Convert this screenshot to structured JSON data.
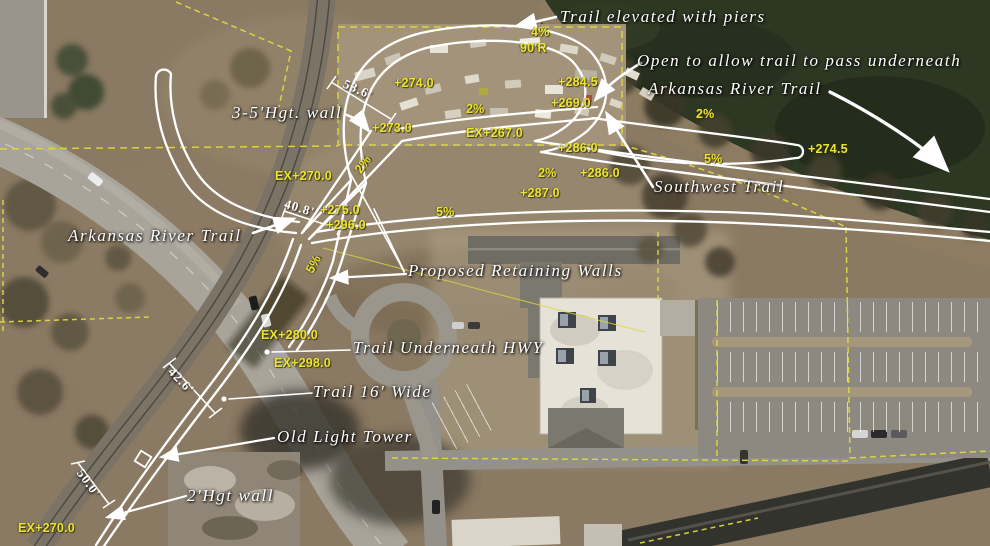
{
  "image": {
    "title": "Aerial trail alignment plan – Arkansas River Trail / Southwest Trail connection",
    "width_px": 990,
    "height_px": 546
  },
  "colors": {
    "annotation_yellow": "#ece433",
    "annotation_white": "#ffffff",
    "boundary_yellow": "#ded83e",
    "river_green": "#2d3823",
    "road_gray": "#a8a49a",
    "dirt_brown": "#8a7963"
  },
  "callouts": [
    {
      "id": "label-trail-elevated-with-piers",
      "text": "Trail elevated with piers",
      "x": 560,
      "y": 7,
      "rot": 0
    },
    {
      "id": "label-open-to-allow-underpass",
      "text": "Open to allow trail to pass underneath",
      "x": 637,
      "y": 51,
      "rot": 0
    },
    {
      "id": "label-arkansas-river-trail-ne",
      "text": "Arkansas River Trail",
      "x": 648,
      "y": 79,
      "rot": 0
    },
    {
      "id": "label-3-5-hgt-wall",
      "text": "3-5'Hgt. wall",
      "x": 232,
      "y": 103,
      "rot": 0
    },
    {
      "id": "label-arkansas-river-trail-w",
      "text": "Arkansas River Trail",
      "x": 68,
      "y": 226,
      "rot": 0
    },
    {
      "id": "label-southwest-trail",
      "text": "Southwest Trail",
      "x": 654,
      "y": 177,
      "rot": 0
    },
    {
      "id": "label-proposed-retaining-walls",
      "text": "Proposed Retaining Walls",
      "x": 408,
      "y": 261,
      "rot": 0
    },
    {
      "id": "label-trail-underneath-hwy",
      "text": "Trail Underneath HWY",
      "x": 353,
      "y": 338,
      "rot": 0
    },
    {
      "id": "label-trail-16-wide",
      "text": "Trail 16' Wide",
      "x": 313,
      "y": 382,
      "rot": 0
    },
    {
      "id": "label-old-light-tower",
      "text": "Old Light Tower",
      "x": 277,
      "y": 427,
      "rot": 0
    },
    {
      "id": "label-2-hgt-wall",
      "text": "2'Hgt wall",
      "x": 187,
      "y": 486,
      "rot": 0
    }
  ],
  "elevations": [
    {
      "id": "grade-4pct",
      "text": "4%",
      "x": 531,
      "y": 25,
      "rot": 0
    },
    {
      "id": "radius-90r",
      "text": "90'R",
      "x": 520,
      "y": 41,
      "rot": 0
    },
    {
      "id": "elev-plus-274-0",
      "text": "+274.0",
      "x": 394,
      "y": 76,
      "rot": 0
    },
    {
      "id": "elev-plus-284-5",
      "text": "+284.5",
      "x": 558,
      "y": 75,
      "rot": 0
    },
    {
      "id": "elev-plus-269-0",
      "text": "+269.0",
      "x": 551,
      "y": 96,
      "rot": 0
    },
    {
      "id": "grade-2pct-a",
      "text": "2%",
      "x": 466,
      "y": 102,
      "rot": 0
    },
    {
      "id": "grade-2pct-b",
      "text": "2%",
      "x": 696,
      "y": 107,
      "rot": 0
    },
    {
      "id": "elev-ex-267-0",
      "text": "EX+267.0",
      "x": 466,
      "y": 126,
      "rot": 0
    },
    {
      "id": "elev-plus-286-0-a",
      "text": "+286.0",
      "x": 558,
      "y": 141,
      "rot": 0
    },
    {
      "id": "grade-2pct-c",
      "text": "2%",
      "x": 538,
      "y": 166,
      "rot": 0
    },
    {
      "id": "elev-plus-286-0-b",
      "text": "+286.0",
      "x": 580,
      "y": 166,
      "rot": 0
    },
    {
      "id": "grade-5pct-a",
      "text": "5%",
      "x": 704,
      "y": 152,
      "rot": 0
    },
    {
      "id": "elev-plus-287-0",
      "text": "+287.0",
      "x": 520,
      "y": 186,
      "rot": 0
    },
    {
      "id": "elev-plus-274-5",
      "text": "+274.5",
      "x": 808,
      "y": 142,
      "rot": 0
    },
    {
      "id": "grade-2pct-d",
      "text": "2%",
      "x": 352,
      "y": 168,
      "rot": -55
    },
    {
      "id": "elev-ex-270-0-a",
      "text": "EX+270.0",
      "x": 275,
      "y": 169,
      "rot": 0
    },
    {
      "id": "elev-plus-273-0",
      "text": "+273.0",
      "x": 372,
      "y": 121,
      "rot": 0
    },
    {
      "id": "elev-plus-275-0",
      "text": "+275.0",
      "x": 320,
      "y": 203,
      "rot": 0
    },
    {
      "id": "elev-plus-296-0",
      "text": "+296.0",
      "x": 326,
      "y": 218,
      "rot": 0
    },
    {
      "id": "grade-5pct-b",
      "text": "5%",
      "x": 436,
      "y": 205,
      "rot": 0
    },
    {
      "id": "grade-5pct-c",
      "text": "5%",
      "x": 303,
      "y": 269,
      "rot": -62
    },
    {
      "id": "elev-ex-280-0",
      "text": "EX+280.0",
      "x": 261,
      "y": 328,
      "rot": 0
    },
    {
      "id": "elev-ex-298-0",
      "text": "EX+298.0",
      "x": 274,
      "y": 356,
      "rot": 0
    },
    {
      "id": "elev-ex-270-0-b",
      "text": "EX+270.0",
      "x": 18,
      "y": 521,
      "rot": 0
    }
  ],
  "dimensions": [
    {
      "id": "dim-53-6",
      "text": "53.6'",
      "x": 347,
      "y": 76,
      "rot": 24
    },
    {
      "id": "dim-40-8",
      "text": "40.8'",
      "x": 287,
      "y": 196,
      "rot": 17
    },
    {
      "id": "dim-42-6",
      "text": "42.6'",
      "x": 176,
      "y": 364,
      "rot": 46
    },
    {
      "id": "dim-50-0",
      "text": "50.0'",
      "x": 86,
      "y": 466,
      "rot": 54
    }
  ]
}
